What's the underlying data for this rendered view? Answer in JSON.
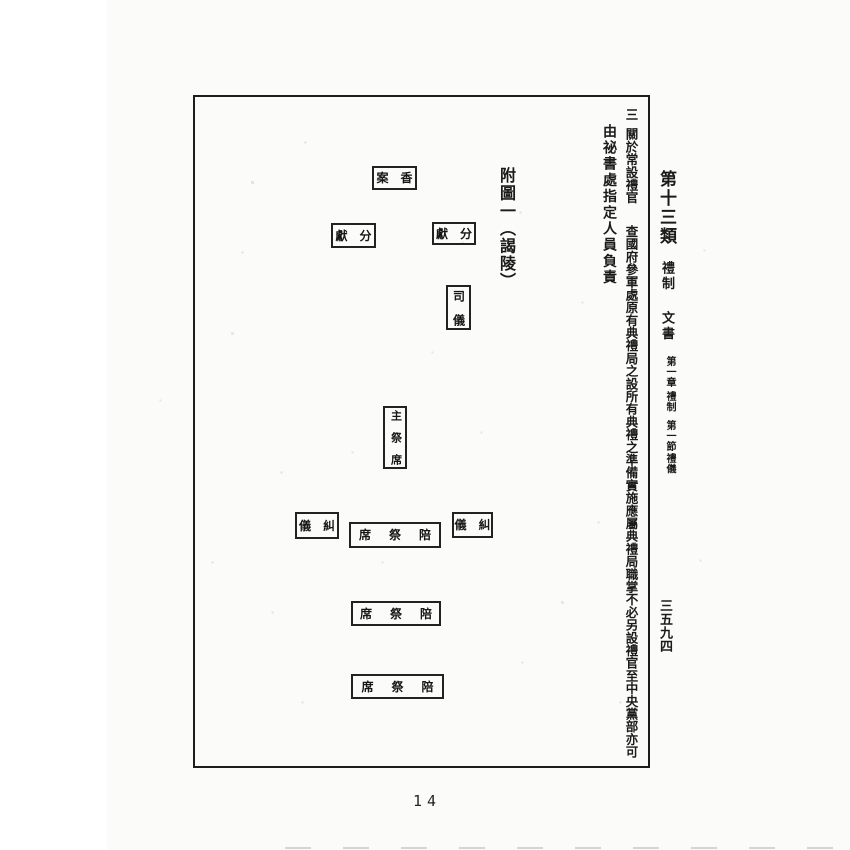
{
  "document": {
    "folio": "14",
    "margin": {
      "category": "第十三類",
      "subject": "禮制",
      "doc_type": "文書",
      "chapter_label": "第一章",
      "chapter_title": "禮制",
      "section_label": "第一節",
      "section_title": "禮儀",
      "page_number_cn": "三五九四"
    },
    "body": {
      "item_no": "三",
      "heading": "關於常設禮官",
      "text": "查國府參軍處原有典禮局之設所有典禮之準備實施應屬典禮局職掌不必另設禮官至中央黨部亦可",
      "text2": "由祕書處指定人員負責"
    },
    "figure": {
      "caption": "附圖一（謁陵）",
      "boxes": [
        {
          "name": "incense-table",
          "display": "案　香",
          "reading": "香案",
          "orientation": "horizontal-rtl"
        },
        {
          "name": "offering-left",
          "display": "獻　分",
          "reading": "分獻",
          "orientation": "horizontal-rtl"
        },
        {
          "name": "offering-right",
          "display": "獻　分",
          "reading": "分獻",
          "orientation": "horizontal-rtl"
        },
        {
          "name": "master-of-ceremonies",
          "display": "司　儀",
          "reading": "司儀",
          "orientation": "vertical"
        },
        {
          "name": "chief-officiant-seat",
          "display": "主　祭　席",
          "reading": "主祭席",
          "orientation": "vertical"
        },
        {
          "name": "proctor-left",
          "display": "儀　糾",
          "reading": "糾儀",
          "orientation": "horizontal-rtl"
        },
        {
          "name": "co-officiant-seat-1",
          "display": "席　祭　陪",
          "reading": "陪祭席",
          "orientation": "horizontal-rtl"
        },
        {
          "name": "proctor-right",
          "display": "儀　糾",
          "reading": "糾儀",
          "orientation": "horizontal-rtl"
        },
        {
          "name": "co-officiant-seat-2",
          "display": "席　祭　陪",
          "reading": "陪祭席",
          "orientation": "horizontal-rtl"
        },
        {
          "name": "co-officiant-seat-3",
          "display": "席　祭　陪",
          "reading": "陪祭席",
          "orientation": "horizontal-rtl"
        }
      ]
    }
  },
  "colors": {
    "paper": "#fbfbfa",
    "ink": "#1c1c1c",
    "frame_border": "#1d1d1d"
  }
}
